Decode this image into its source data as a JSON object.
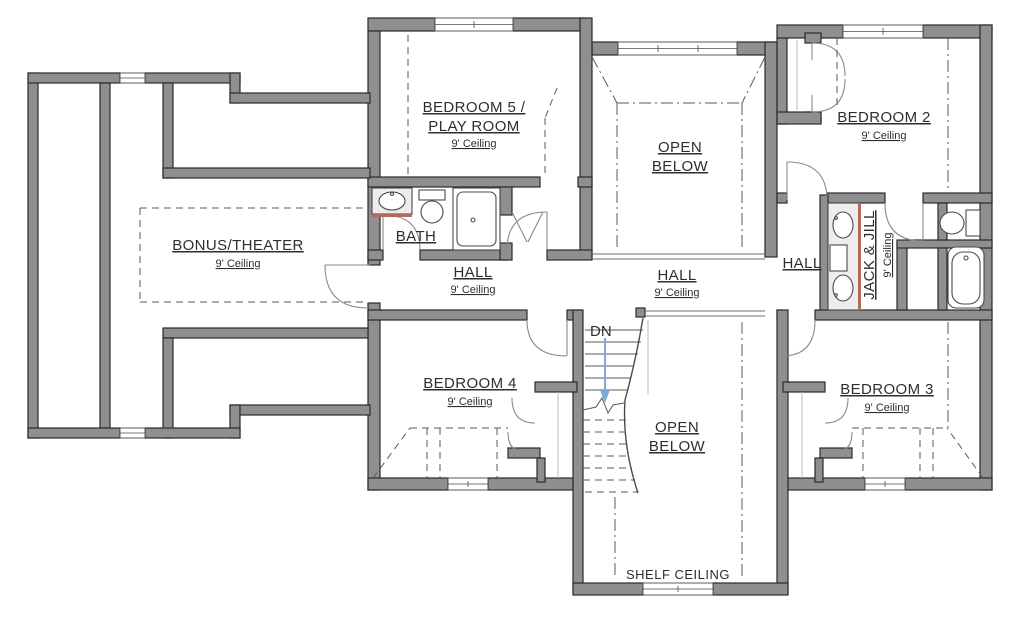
{
  "plan": {
    "type": "second-floor-plan",
    "colors": {
      "wall_fill": "#8f8f8f",
      "wall_stroke": "#2b2b2b",
      "vanity_accent": "#b06a5e",
      "down_arrow": "#7fa8d8",
      "dash_lines": "#5a5a5a",
      "background": "#ffffff"
    }
  },
  "labels": {
    "bedroom5_line1": "BEDROOM 5 /",
    "bedroom5_line2": "PLAY ROOM",
    "bedroom5_ceiling": "9' Ceiling",
    "open_below_top_line1": "OPEN",
    "open_below_top_line2": "BELOW",
    "bedroom2": "BEDROOM 2",
    "bedroom2_ceiling": "9' Ceiling",
    "bonus": "BONUS/THEATER",
    "bonus_ceiling": "9' Ceiling",
    "bath": "BATH",
    "hall_left": "HALL",
    "hall_left_ceiling": "9' Ceiling",
    "hall_mid": "HALL",
    "hall_mid_ceiling": "9' Ceiling",
    "hall_right": "HALL",
    "jackjill": "JACK & JILL",
    "jackjill_ceiling": "9' Ceiling",
    "dn": "DN",
    "bedroom4": "BEDROOM 4",
    "bedroom4_ceiling": "9' Ceiling",
    "open_below_bottom_line1": "OPEN",
    "open_below_bottom_line2": "BELOW",
    "bedroom3": "BEDROOM 3",
    "bedroom3_ceiling": "9' Ceiling",
    "shelf_ceiling": "SHELF CEILING"
  }
}
